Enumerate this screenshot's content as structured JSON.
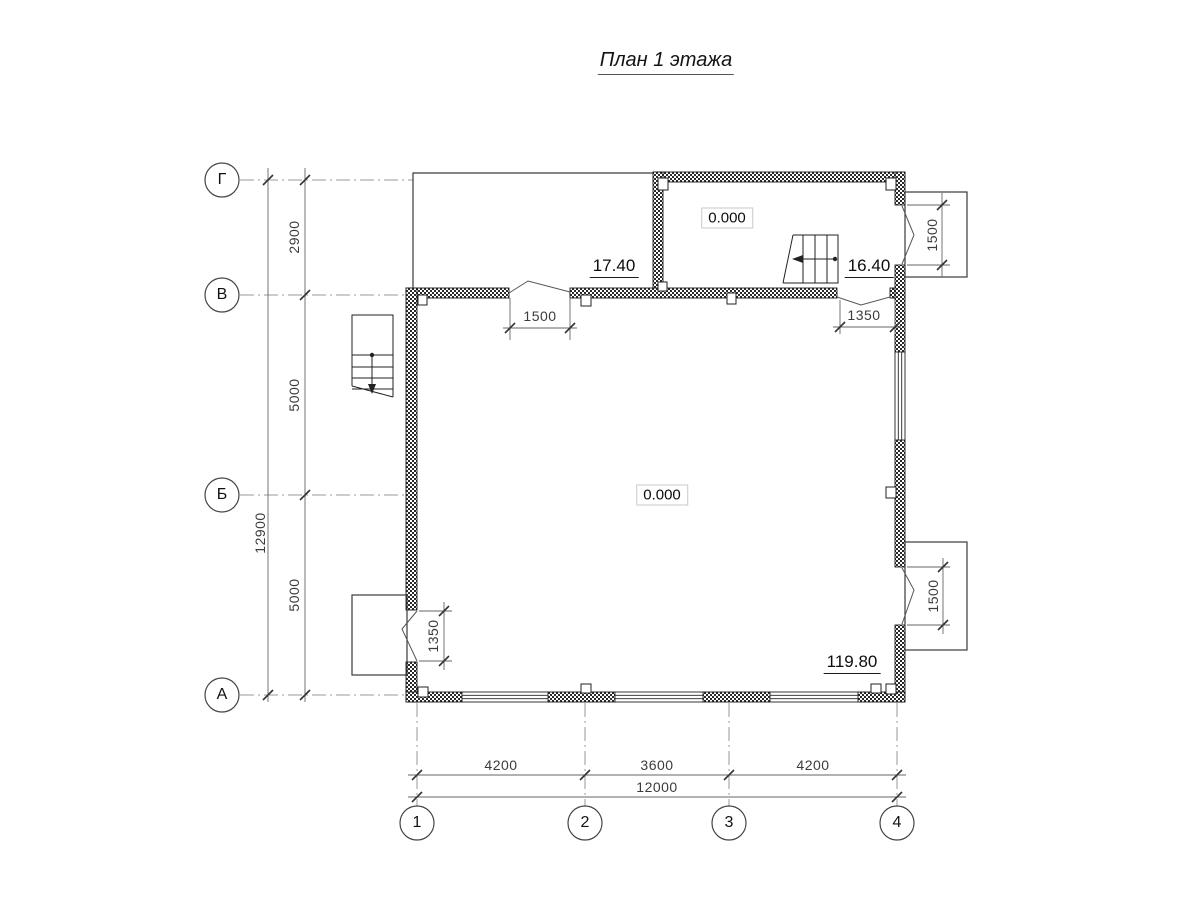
{
  "title": "План 1 этажа",
  "axes": {
    "rows": [
      "Г",
      "В",
      "Б",
      "А"
    ],
    "cols": [
      "1",
      "2",
      "3",
      "4"
    ]
  },
  "dims": {
    "left_segments": [
      "2900",
      "5000",
      "5000"
    ],
    "left_total": "12900",
    "bottom_segments": [
      "4200",
      "3600",
      "4200"
    ],
    "bottom_total": "12000",
    "openings": {
      "entry_top": "1500",
      "entry_upper_right": "1350",
      "porch_upper_right": "1500",
      "porch_lower_right": "1500",
      "porch_left": "1350"
    }
  },
  "elevations": {
    "upper_room": "0.000",
    "main_room": "0.000",
    "upper_landing": "17.40",
    "entry_landing": "16.40",
    "terrace": "119.80"
  },
  "colors": {
    "wall_hatch": "#2a2a2a",
    "outline": "#1a1a1a",
    "dim_line": "#666666",
    "axis_line": "#999999",
    "dim_text": "#3c3c3c"
  }
}
